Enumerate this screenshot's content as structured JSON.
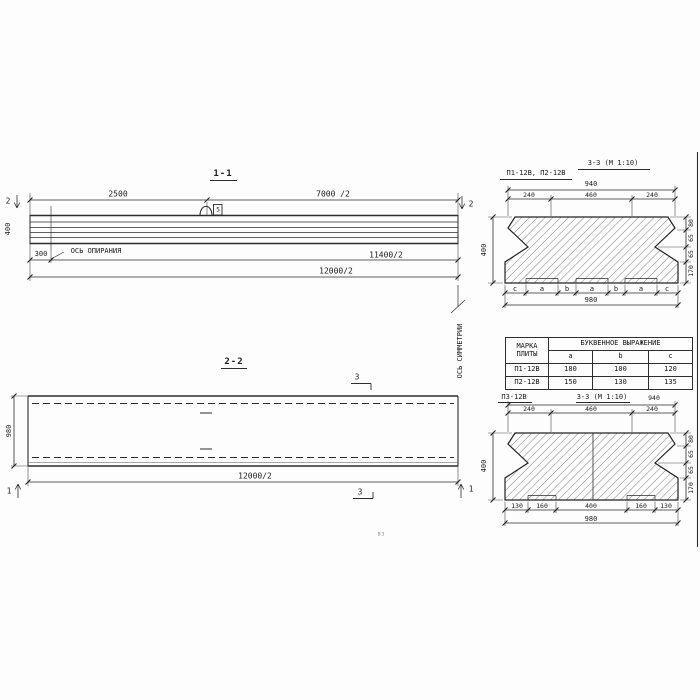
{
  "palette": {
    "ink": "#1e1e1e",
    "paper": "#fdfdfd"
  },
  "section11": {
    "title": "1-1",
    "dim_top_left": "2500",
    "dim_top_right": "7000 /2",
    "dim_height": "400",
    "dim_offset": "300",
    "support_axis_label": "ОСЬ ОПИРАНИЯ",
    "dim_half_span": "11400/2",
    "dim_half_length": "12000/2",
    "cut_marker": "2",
    "loop_tag": "5"
  },
  "section22": {
    "title": "2-2",
    "dim_width": "980",
    "dim_half_length": "12000/2",
    "cut_marker_3": "3",
    "cut_marker_1": "1",
    "symmetry_axis_label": "ОСЬ СИММЕТРИИ"
  },
  "section33_top": {
    "label": "П1-12В, П2-12В",
    "title": "3-3 (М 1:10)",
    "dim_overall_top": "940",
    "dims_top": [
      "240",
      "460",
      "240"
    ],
    "dim_height": "400",
    "dims_right": [
      "80",
      "65",
      "65",
      "170"
    ],
    "letter_dims": [
      "c",
      "a",
      "b",
      "a",
      "b",
      "a",
      "c"
    ],
    "dim_overall_bottom": "980"
  },
  "spec_table": {
    "header_mark": [
      "МАРКА",
      "ПЛИТЫ"
    ],
    "header_expression": "БУКВЕННОЕ ВЫРАЖЕНИЕ",
    "columns": [
      "a",
      "b",
      "c"
    ],
    "rows": [
      {
        "mark": "П1-12В",
        "a": "180",
        "b": "100",
        "c": "120"
      },
      {
        "mark": "П2-12В",
        "a": "150",
        "b": "130",
        "c": "135"
      }
    ]
  },
  "section33_bottom": {
    "label": "П3-12В",
    "title": "3-3 (М 1:10)",
    "dim_overall_top": "940",
    "dims_top": [
      "240",
      "460",
      "240"
    ],
    "dim_height": "400",
    "dims_right": [
      "80",
      "65",
      "65",
      "170"
    ],
    "dims_bottom": [
      "130",
      "160",
      "400",
      "160",
      "130"
    ],
    "dim_overall_bottom": "980"
  },
  "stray_mark": "вз"
}
